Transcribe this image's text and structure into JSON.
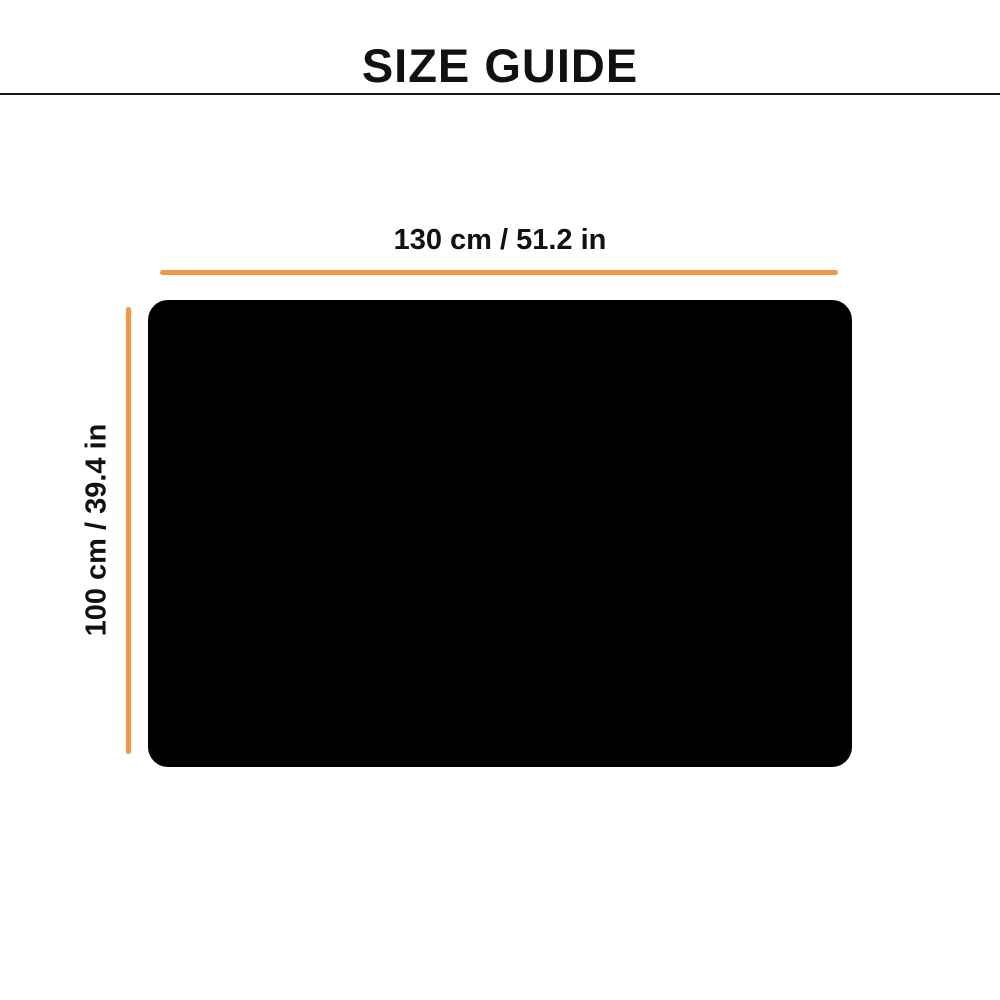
{
  "header": {
    "title": "SIZE GUIDE"
  },
  "diagram": {
    "width_label": "130 cm / 51.2 in",
    "height_label": "100 cm / 39.4 in",
    "width_cm": 130,
    "width_in": 51.2,
    "height_cm": 100,
    "height_in": 39.4,
    "accent_color": "#F8953E",
    "item_color": "#000000",
    "text_color": "#111111"
  }
}
